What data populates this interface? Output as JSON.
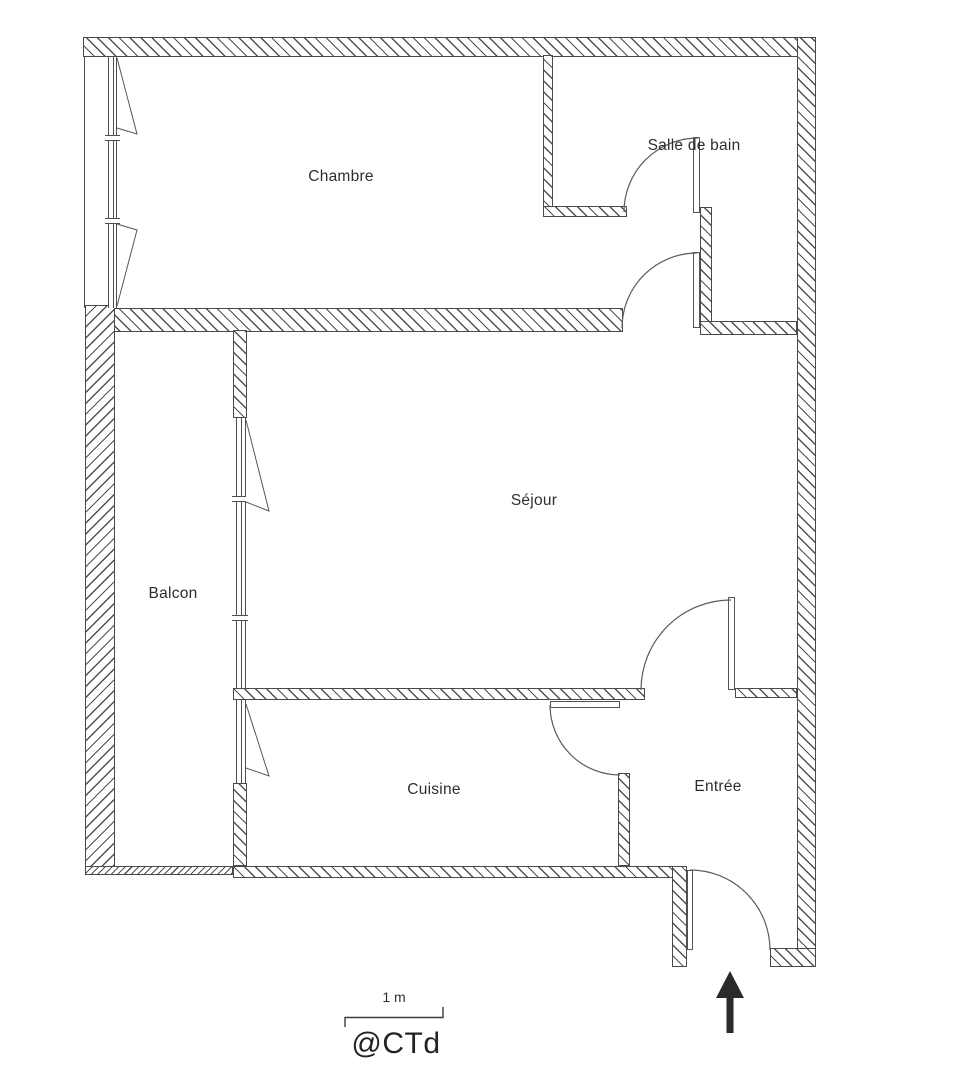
{
  "plan": {
    "rooms": [
      {
        "label": "Chambre"
      },
      {
        "label": "Salle de bain"
      },
      {
        "label": "Séjour"
      },
      {
        "label": "Balcon"
      },
      {
        "label": "Cuisine"
      },
      {
        "label": "Entrée"
      }
    ],
    "scale_bar": {
      "label": "1 m"
    },
    "credit": {
      "label": "@CTd"
    },
    "colors": {
      "wall": "#4a4a4a",
      "text": "#2e2e2e",
      "arrow": "#2a2a2a",
      "background": "#ffffff"
    }
  }
}
